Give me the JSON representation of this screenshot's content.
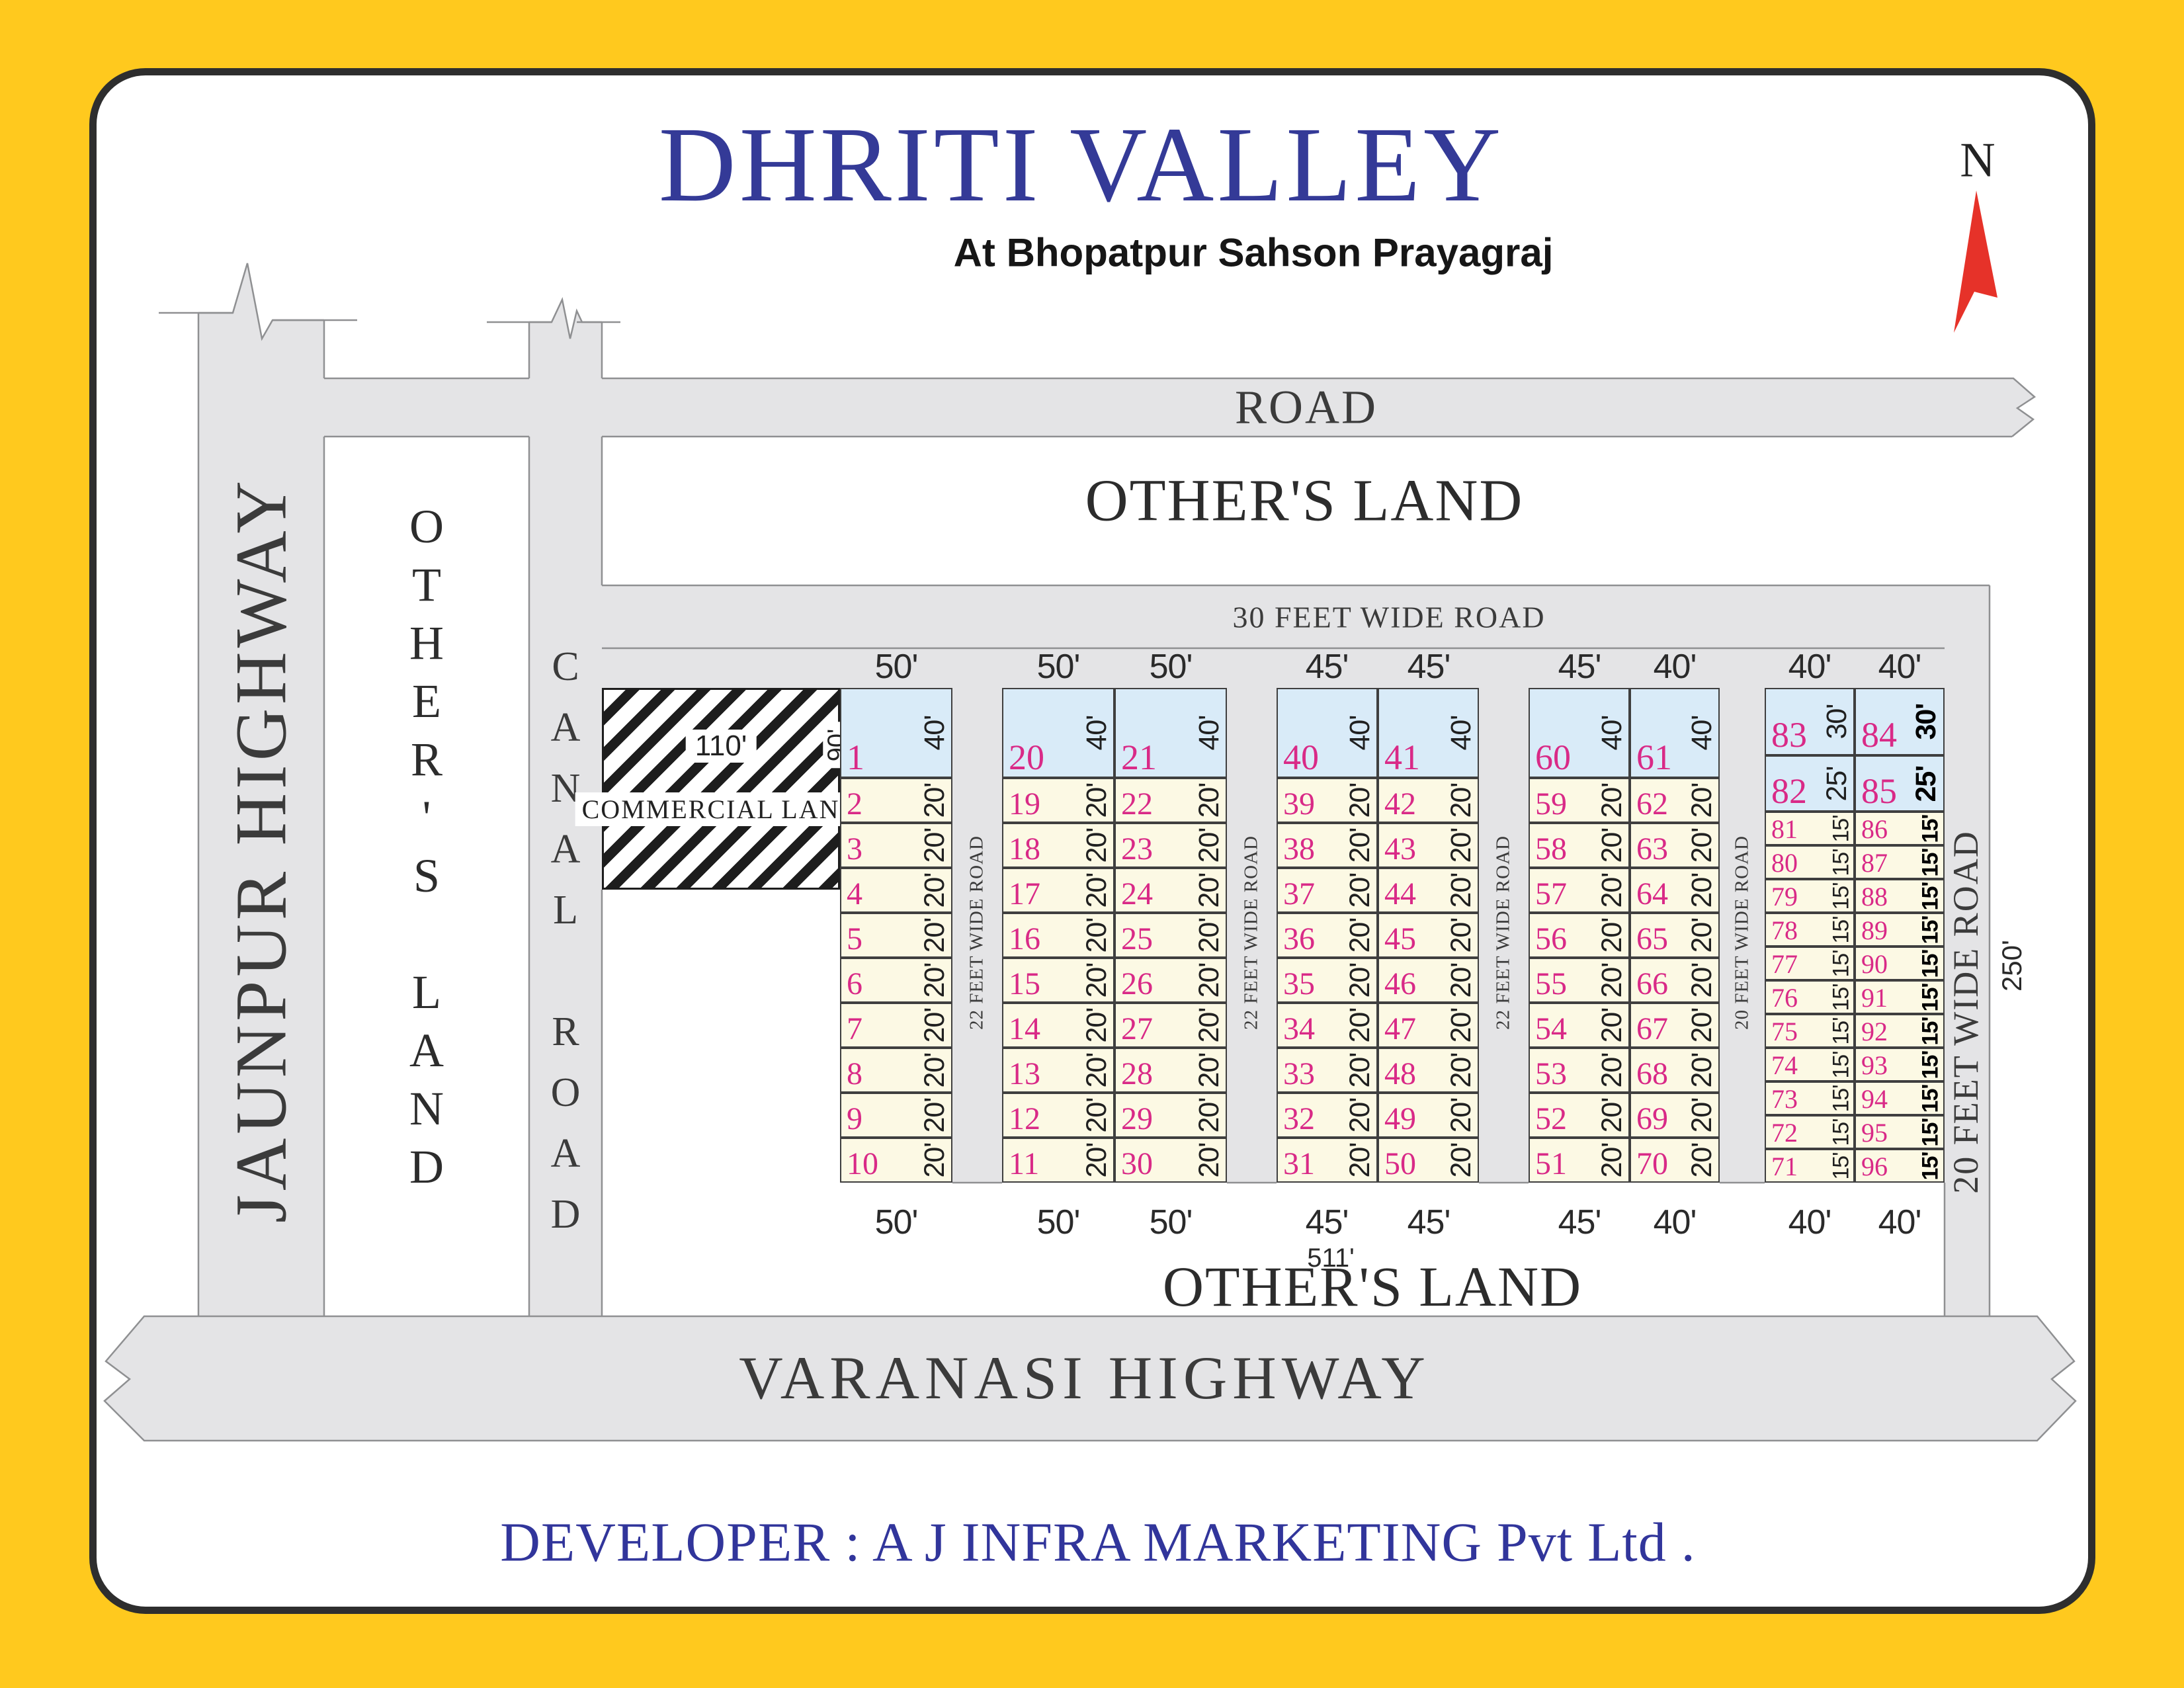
{
  "title": "DHRITI VALLEY",
  "subtitle": "At Bhopatpur Sahson Prayagraj",
  "developer": "DEVELOPER : A J INFRA MARKETING Pvt Ltd .",
  "compass": {
    "label": "N"
  },
  "colors": {
    "frame_yellow": "#ffc91e",
    "title_navy": "#343a97",
    "plot_number_pink": "#d92a87",
    "plot_blue_fill": "#d9ebf8",
    "plot_cream_fill": "#fcf9e4",
    "road_gray": "#e4e4e6",
    "north_arrow_red": "#e63229"
  },
  "roads": {
    "top": "ROAD",
    "thirty_feet": "30 FEET WIDE ROAD",
    "jaunpur": "JAUNPUR HIGHWAY",
    "canal": "CANAL ROAD",
    "varanasi": "VARANASI HIGHWAY",
    "right_big": "20 FEET WIDE ROAD",
    "between": [
      "22 FEET WIDE ROAD",
      "22 FEET WIDE ROAD",
      "22 FEET WIDE ROAD",
      "20 FEET WIDE ROAD"
    ]
  },
  "lands": {
    "top": "OTHER'S LAND",
    "left": "OTHER'S LAND",
    "bottom": "OTHER'S LAND"
  },
  "commercial": {
    "label": "COMMERCIAL LAND",
    "width": "110'",
    "height": "90'"
  },
  "measurements": {
    "total_width": "511'",
    "total_height": "250'"
  },
  "width_labels": {
    "top": [
      "50'",
      "50'",
      "50'",
      "45'",
      "45'",
      "45'",
      "40'",
      "40'",
      "40'"
    ],
    "bottom": [
      "50'",
      "50'",
      "50'",
      "45'",
      "45'",
      "45'",
      "40'",
      "40'",
      "40'"
    ]
  },
  "blocks": [
    {
      "columns": [
        {
          "plots": [
            {
              "n": "1",
              "d": "40'",
              "c": "blue"
            },
            {
              "n": "2",
              "d": "20'"
            },
            {
              "n": "3",
              "d": "20'"
            },
            {
              "n": "4",
              "d": "20'"
            },
            {
              "n": "5",
              "d": "20'"
            },
            {
              "n": "6",
              "d": "20'"
            },
            {
              "n": "7",
              "d": "20'"
            },
            {
              "n": "8",
              "d": "20'"
            },
            {
              "n": "9",
              "d": "20'"
            },
            {
              "n": "10",
              "d": "20'"
            }
          ]
        }
      ]
    },
    {
      "columns": [
        {
          "plots": [
            {
              "n": "20",
              "d": "40'",
              "c": "blue"
            },
            {
              "n": "19",
              "d": "20'"
            },
            {
              "n": "18",
              "d": "20'"
            },
            {
              "n": "17",
              "d": "20'"
            },
            {
              "n": "16",
              "d": "20'"
            },
            {
              "n": "15",
              "d": "20'"
            },
            {
              "n": "14",
              "d": "20'"
            },
            {
              "n": "13",
              "d": "20'"
            },
            {
              "n": "12",
              "d": "20'"
            },
            {
              "n": "11",
              "d": "20'"
            }
          ]
        },
        {
          "plots": [
            {
              "n": "21",
              "d": "40'",
              "c": "blue"
            },
            {
              "n": "22",
              "d": "20'"
            },
            {
              "n": "23",
              "d": "20'"
            },
            {
              "n": "24",
              "d": "20'"
            },
            {
              "n": "25",
              "d": "20'"
            },
            {
              "n": "26",
              "d": "20'"
            },
            {
              "n": "27",
              "d": "20'"
            },
            {
              "n": "28",
              "d": "20'"
            },
            {
              "n": "29",
              "d": "20'"
            },
            {
              "n": "30",
              "d": "20'"
            }
          ]
        }
      ]
    },
    {
      "columns": [
        {
          "plots": [
            {
              "n": "40",
              "d": "40'",
              "c": "blue"
            },
            {
              "n": "39",
              "d": "20'"
            },
            {
              "n": "38",
              "d": "20'"
            },
            {
              "n": "37",
              "d": "20'"
            },
            {
              "n": "36",
              "d": "20'"
            },
            {
              "n": "35",
              "d": "20'"
            },
            {
              "n": "34",
              "d": "20'"
            },
            {
              "n": "33",
              "d": "20'"
            },
            {
              "n": "32",
              "d": "20'"
            },
            {
              "n": "31",
              "d": "20'"
            }
          ]
        },
        {
          "plots": [
            {
              "n": "41",
              "d": "40'",
              "c": "blue"
            },
            {
              "n": "42",
              "d": "20'"
            },
            {
              "n": "43",
              "d": "20'"
            },
            {
              "n": "44",
              "d": "20'"
            },
            {
              "n": "45",
              "d": "20'"
            },
            {
              "n": "46",
              "d": "20'"
            },
            {
              "n": "47",
              "d": "20'"
            },
            {
              "n": "48",
              "d": "20'"
            },
            {
              "n": "49",
              "d": "20'"
            },
            {
              "n": "50",
              "d": "20'"
            }
          ]
        }
      ]
    },
    {
      "columns": [
        {
          "plots": [
            {
              "n": "60",
              "d": "40'",
              "c": "blue"
            },
            {
              "n": "59",
              "d": "20'"
            },
            {
              "n": "58",
              "d": "20'"
            },
            {
              "n": "57",
              "d": "20'"
            },
            {
              "n": "56",
              "d": "20'"
            },
            {
              "n": "55",
              "d": "20'"
            },
            {
              "n": "54",
              "d": "20'"
            },
            {
              "n": "53",
              "d": "20'"
            },
            {
              "n": "52",
              "d": "20'"
            },
            {
              "n": "51",
              "d": "20'"
            }
          ]
        },
        {
          "plots": [
            {
              "n": "61",
              "d": "40'",
              "c": "blue"
            },
            {
              "n": "62",
              "d": "20'"
            },
            {
              "n": "63",
              "d": "20'"
            },
            {
              "n": "64",
              "d": "20'"
            },
            {
              "n": "65",
              "d": "20'"
            },
            {
              "n": "66",
              "d": "20'"
            },
            {
              "n": "67",
              "d": "20'"
            },
            {
              "n": "68",
              "d": "20'"
            },
            {
              "n": "69",
              "d": "20'"
            },
            {
              "n": "70",
              "d": "20'"
            }
          ]
        }
      ]
    },
    {
      "columns": [
        {
          "plots": [
            {
              "n": "83",
              "d": "30'",
              "c": "blue"
            },
            {
              "n": "82",
              "d": "25'",
              "c": "blue"
            },
            {
              "n": "81",
              "d": "15'"
            },
            {
              "n": "80",
              "d": "15'"
            },
            {
              "n": "79",
              "d": "15'"
            },
            {
              "n": "78",
              "d": "15'"
            },
            {
              "n": "77",
              "d": "15'"
            },
            {
              "n": "76",
              "d": "15'"
            },
            {
              "n": "75",
              "d": "15'"
            },
            {
              "n": "74",
              "d": "15'"
            },
            {
              "n": "73",
              "d": "15'"
            },
            {
              "n": "72",
              "d": "15'"
            },
            {
              "n": "71",
              "d": "15'"
            }
          ]
        },
        {
          "plots": [
            {
              "n": "84",
              "d": "30'",
              "c": "blue"
            },
            {
              "n": "85",
              "d": "25'",
              "c": "blue"
            },
            {
              "n": "86",
              "d": "15'"
            },
            {
              "n": "87",
              "d": "15'"
            },
            {
              "n": "88",
              "d": "15'"
            },
            {
              "n": "89",
              "d": "15'"
            },
            {
              "n": "90",
              "d": "15'"
            },
            {
              "n": "91",
              "d": "15'"
            },
            {
              "n": "92",
              "d": "15'"
            },
            {
              "n": "93",
              "d": "15'"
            },
            {
              "n": "94",
              "d": "15'"
            },
            {
              "n": "95",
              "d": "15'"
            },
            {
              "n": "96",
              "d": "15'"
            }
          ]
        }
      ]
    }
  ]
}
